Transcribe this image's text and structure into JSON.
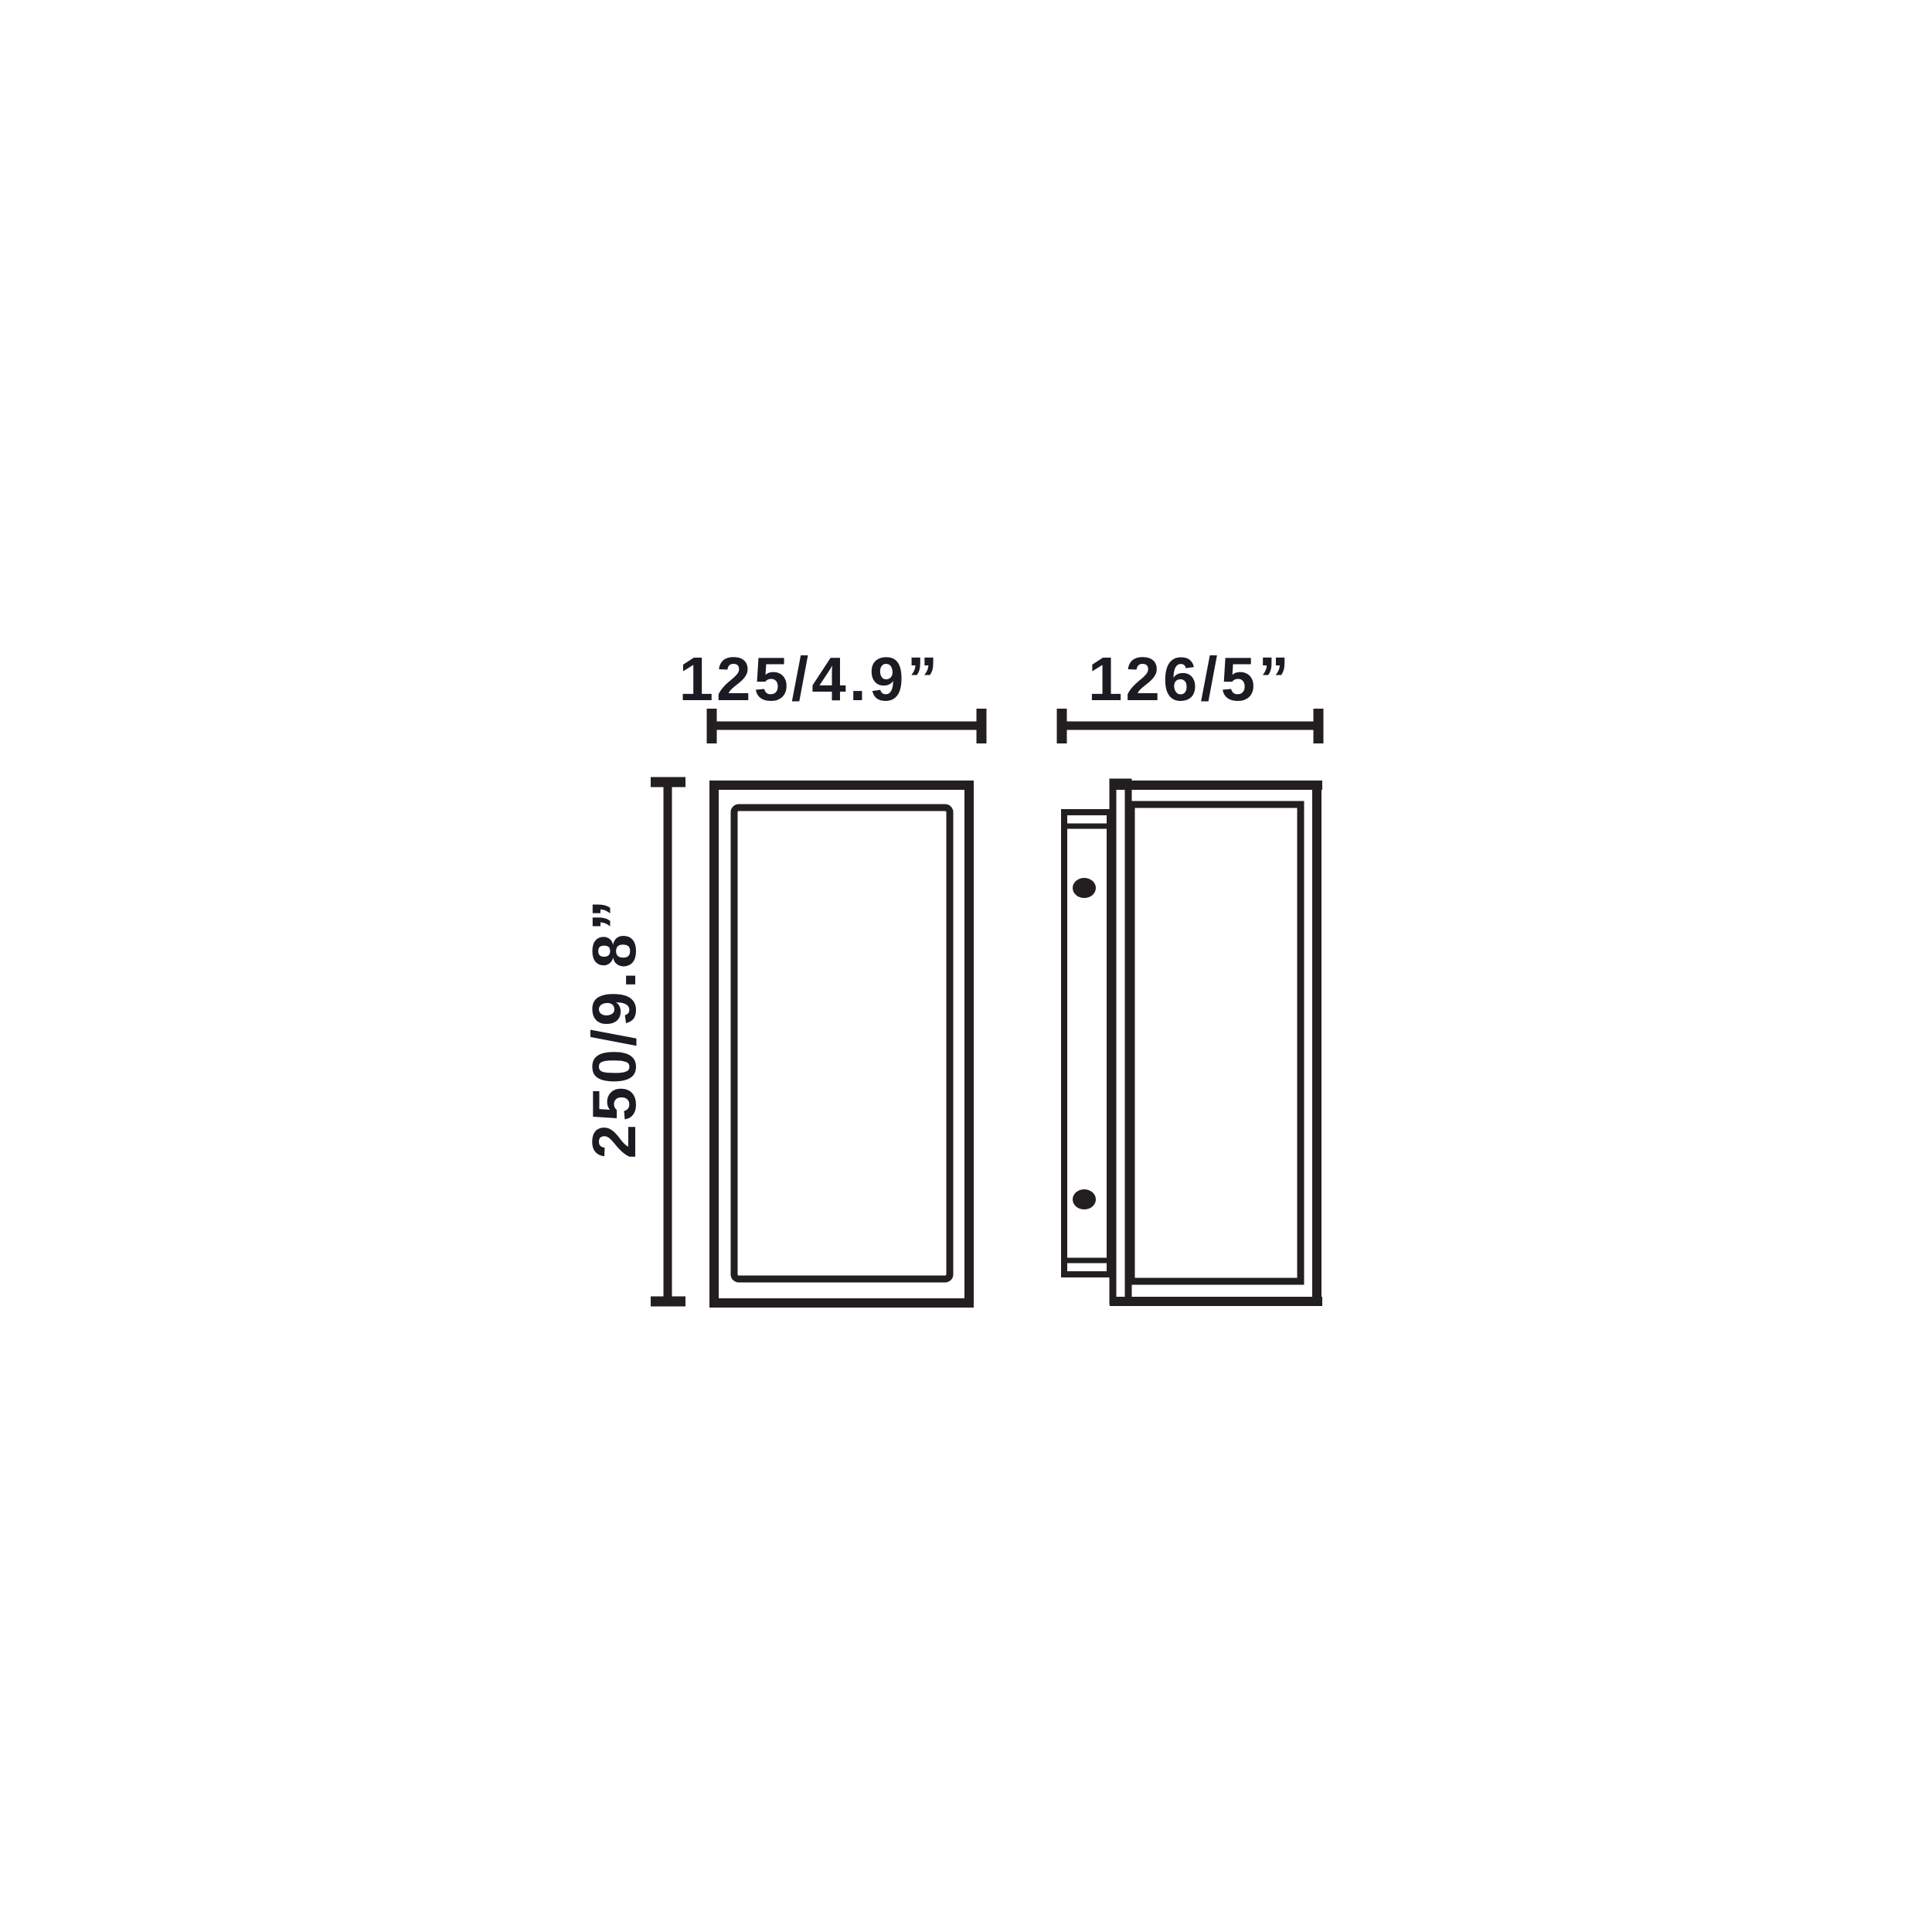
{
  "drawing": {
    "title": "wall-lamp-dimension-diagram",
    "views": {
      "front": {
        "width_dimension": "125/4.9”",
        "height_dimension": "250/9.8”"
      },
      "side": {
        "depth_dimension": "126/5”"
      }
    }
  },
  "colors": {
    "line": "#231f20",
    "text": "#1b1b23",
    "background": "#ffffff"
  }
}
